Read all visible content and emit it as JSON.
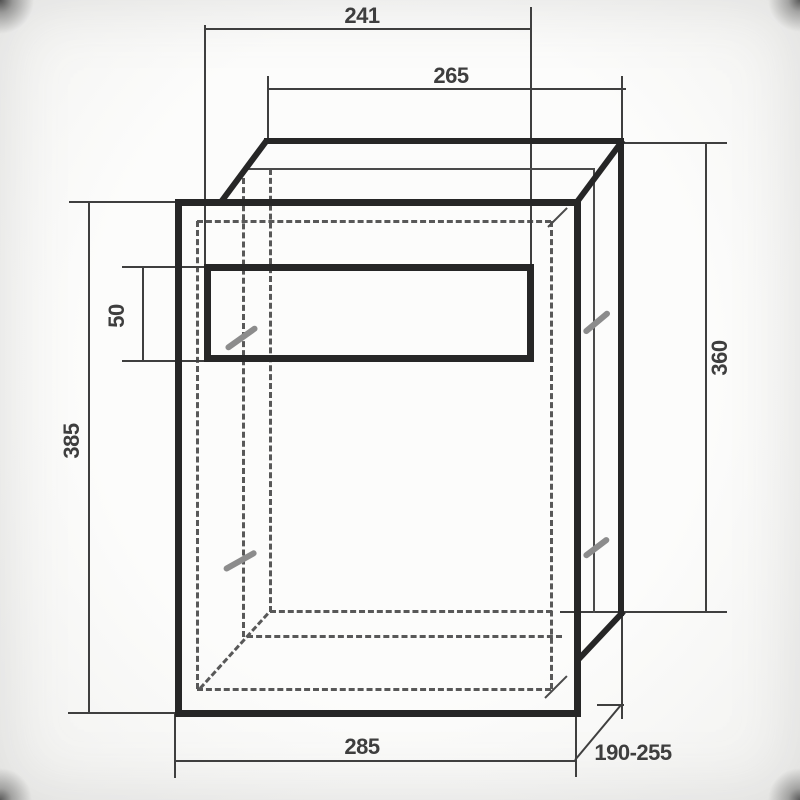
{
  "drawing": {
    "kind": "technical dimension drawing of wall letterbox",
    "dimensions": {
      "slot_width": "241",
      "body_width": "265",
      "slot_height": "50",
      "front_panel_height": "385",
      "body_height": "360",
      "front_panel_width": "285",
      "body_depth_range": "190-255"
    },
    "colors": {
      "line": "#262626",
      "thin_line": "#4a4a4a",
      "dim_line": "#3f3f3f",
      "dashed": "#585858",
      "marker": "#8c8c8c",
      "label": "#3e3e3e",
      "background": "#f7f7f5"
    }
  }
}
